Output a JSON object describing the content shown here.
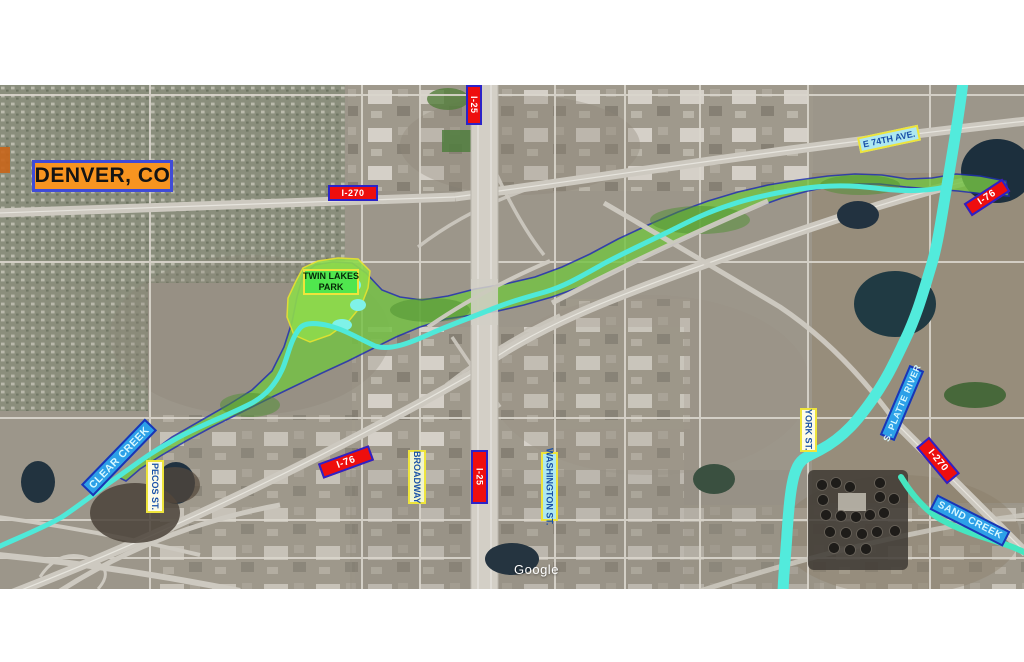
{
  "map_labels": {
    "city_title": "DENVER, CO",
    "i270_west": "I-270",
    "i25_north": "I-25",
    "e_74th_ave": "E 74TH AVE.",
    "i76_northeast": "I-76",
    "twin_lakes_line1": "TWIN LAKES",
    "twin_lakes_line2": "PARK",
    "clear_creek": "CLEAR CREEK",
    "pecos_st": "PECOS ST.",
    "i76_central": "I-76",
    "broadway": "BROADWAY",
    "i25_central": "I-25",
    "washington_st": "WASHINGTON ST.",
    "york_st": "YORK ST.",
    "s_platte_river": "S. PLATTE RIVER",
    "i270_east": "I-270",
    "sand_creek": "SAND CREEK"
  },
  "watermark": "Google",
  "colors": {
    "interstate_bg": "#EE0E0E",
    "interstate_border": "#2B23C8",
    "interstate_text": "#FFFFFF",
    "street_label_border": "#EEE43B",
    "street_label_text": "#1A52A8",
    "water_label_bg": "#2CA0E8",
    "water_label_border": "#1A35B5",
    "water_label_text": "#D6F8FF",
    "park_label_bg": "#50E64E",
    "title_bg": "#F79420",
    "title_border": "#3F4BD8",
    "greenway_fill": "#74C244",
    "greenway_outline": "#1D2FAE",
    "creek_water": "#4FE9D9",
    "park_fill": "#8EDB4C"
  }
}
